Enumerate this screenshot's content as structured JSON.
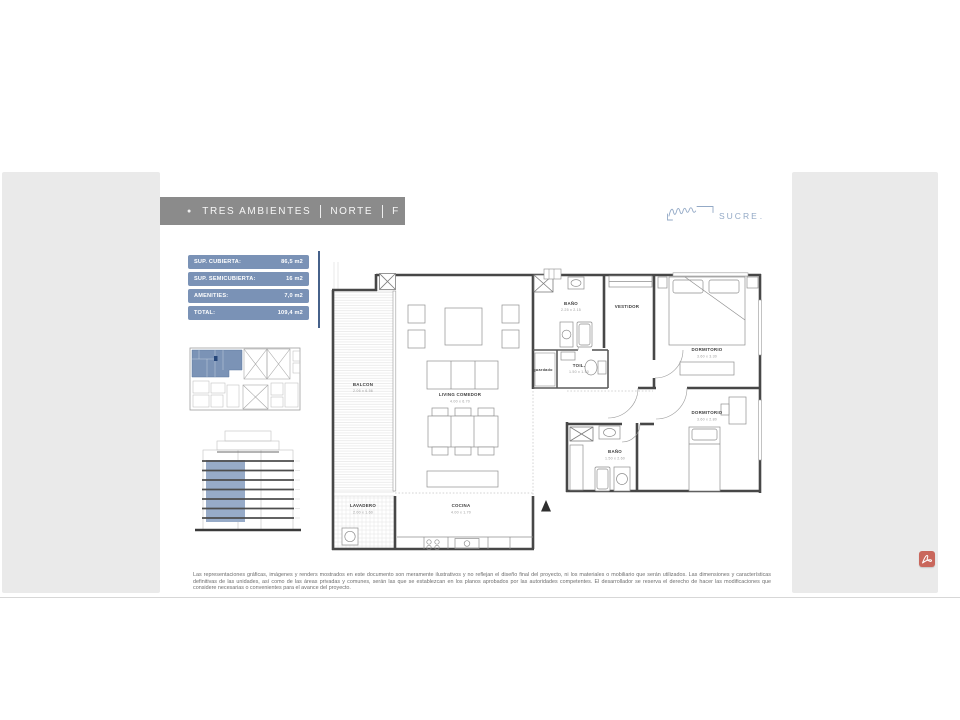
{
  "slide": {
    "title": {
      "marker": "●",
      "segments": [
        "TRES AMBIENTES",
        "NORTE",
        "F"
      ]
    },
    "logo": {
      "name": "SUCRE",
      "dot": "."
    },
    "summary_table": {
      "rows": [
        {
          "label": "SUP. CUBIERTA:",
          "value": "86,5 m2"
        },
        {
          "label": "SUP. SEMICUBIERTA:",
          "value": "16 m2"
        },
        {
          "label": "AMENITIES:",
          "value": "7,0 m2"
        },
        {
          "label": "TOTAL:",
          "value": "109,4 m2"
        }
      ]
    },
    "plan": {
      "rooms": {
        "balcon": {
          "name": "BALCON",
          "dims": "2.06 x 6.56"
        },
        "living": {
          "name": "LIVING COMEDOR",
          "dims": "4.00 x 6.70"
        },
        "banio1": {
          "name": "BAÑO",
          "dims": "2.25 x 2.15"
        },
        "vestidor": {
          "name": "VESTIDOR",
          "dims": ""
        },
        "guardado": {
          "name": "guardado",
          "dims": ""
        },
        "toil": {
          "name": "TOIL.",
          "dims": "1.50 x 1.50"
        },
        "dorm1": {
          "name": "DORMITORIO",
          "dims": "3.60 x 3.30"
        },
        "dorm2": {
          "name": "DORMITORIO",
          "dims": "3.60 x 2.80"
        },
        "banio2": {
          "name": "BAÑO",
          "dims": "1.50 x 2.60"
        },
        "lavadero": {
          "name": "LAVADERO",
          "dims": "2.00 x 1.60"
        },
        "cocina": {
          "name": "COCINA",
          "dims": "4.00 x 1.70"
        }
      }
    },
    "disclaimer": "Las representaciones gráficas, imágenes y renders mostrados en este documento son meramente ilustrativos y no reflejan el diseño final del proyecto, ni los materiales o mobiliario que serán utilizados. Las dimensiones y características definitivas de las unidades, así como de las áreas privadas y comunes, serán las que se establezcan en los planos aprobados por las autoridades competentes. El desarrollador se reserva el derecho de hacer las modificaciones que considere necesarias o convenientes para el avance del proyecto."
  },
  "icons": {
    "pdf_badge": "adobe-pdf-icon",
    "north_arrow": "north-arrow-icon",
    "title_marker": "bullet-icon",
    "signature": "signature-scribble-icon"
  },
  "colors": {
    "accent_blue": "#7a92b6",
    "elevation_blue": "#97abc8",
    "title_bar_grey": "#8b8b8b",
    "logo_blue": "#93a9c6",
    "panel_grey": "#eaeaea",
    "divider_blue": "#46618a",
    "pdf_red": "#c9675c"
  }
}
